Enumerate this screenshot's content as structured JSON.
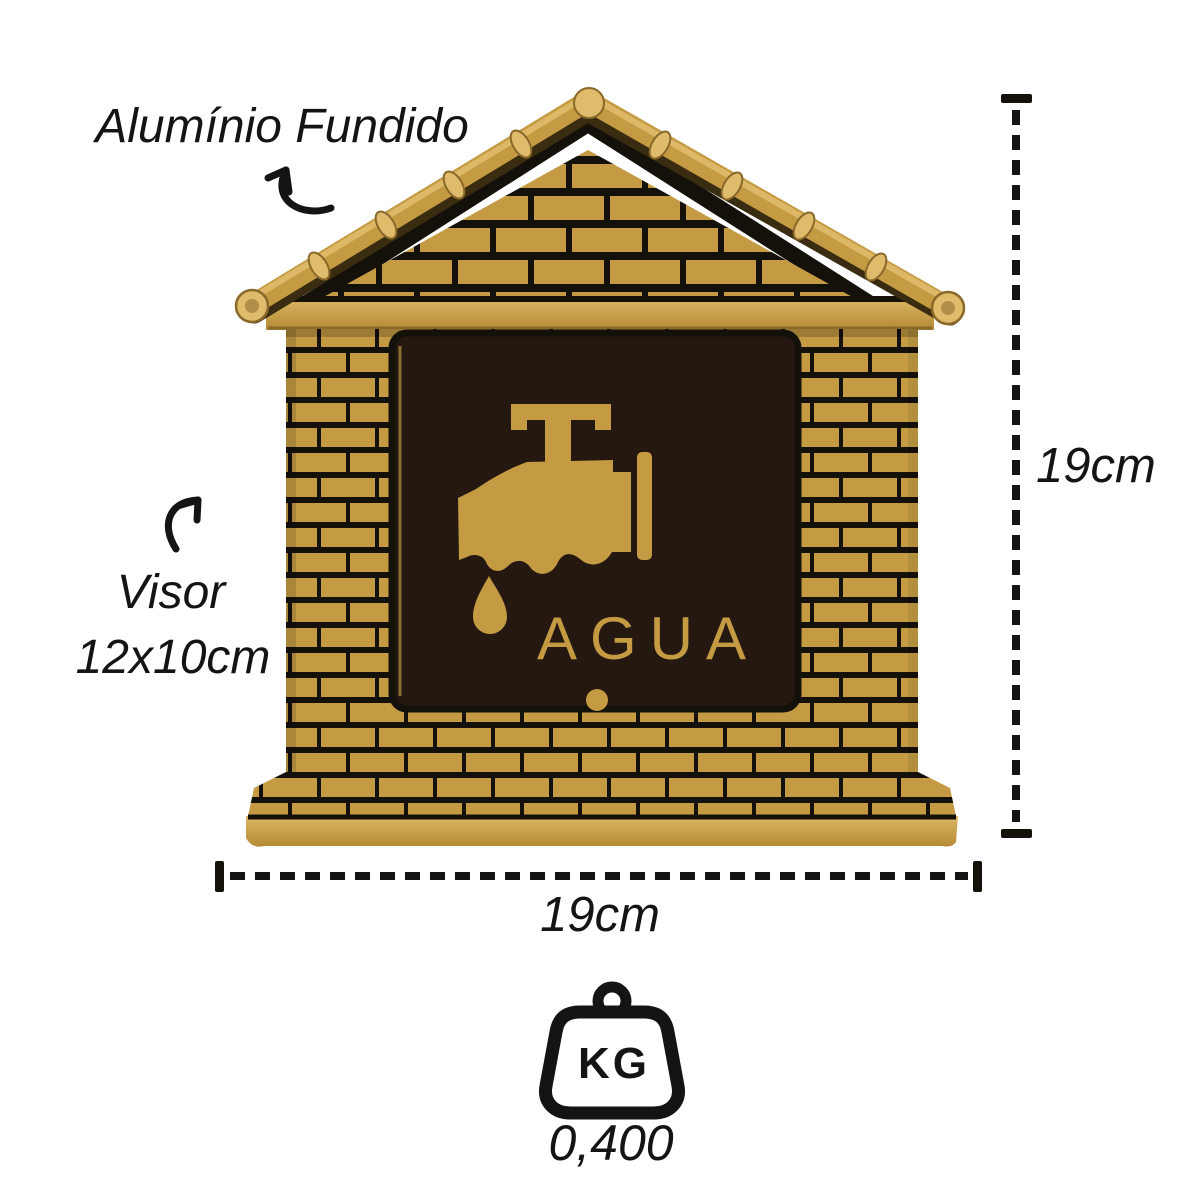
{
  "annotations": {
    "material_label": "Alumínio Fundido",
    "visor_label_line1": "Visor",
    "visor_label_line2": "12x10cm",
    "height_label": "19cm",
    "width_label": "19cm"
  },
  "product": {
    "window_label": "AGUA"
  },
  "weight": {
    "unit_label": "KG",
    "value": "0,400"
  },
  "colors": {
    "gold": "#C49B42",
    "gold_light": "#DFBC6C",
    "gold_dark": "#8A6829",
    "black": "#14100A",
    "window_bg": "#241810",
    "ink": "#141414",
    "background": "#FFFFFF"
  }
}
